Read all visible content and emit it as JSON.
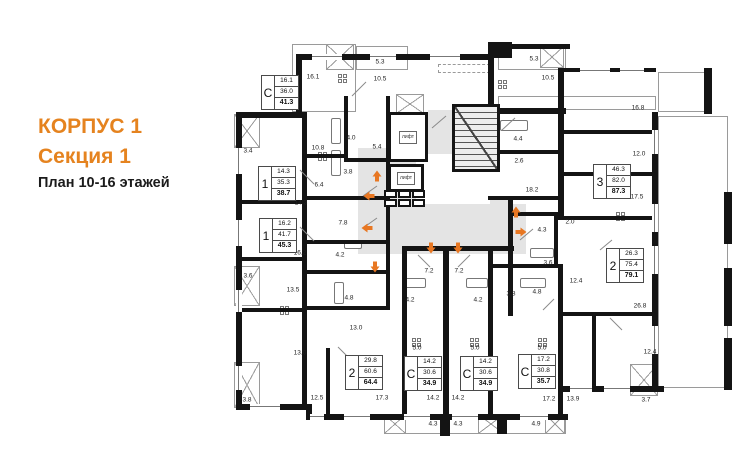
{
  "header": {
    "building": "КОРПУС 1",
    "section": "Секция 1",
    "plan": "План 10-16 этажей"
  },
  "colors": {
    "accent": "#E5831F",
    "arrow": "#E87722",
    "wall": "#141414",
    "corridor": "#E4E4E4"
  },
  "elevators": [
    {
      "label": "лифт",
      "x": 388,
      "y": 112,
      "w": 40,
      "h": 50
    },
    {
      "label": "лифт",
      "x": 388,
      "y": 164,
      "w": 36,
      "h": 28
    }
  ],
  "apartments": [
    {
      "type": "С",
      "room_area": "16.1",
      "living_area": "36.0",
      "total_area": "41.3",
      "x": 261,
      "y": 75
    },
    {
      "type": "1",
      "room_area": "14.3",
      "living_area": "35.3",
      "total_area": "38.7",
      "x": 258,
      "y": 166
    },
    {
      "type": "1",
      "room_area": "16.2",
      "living_area": "41.7",
      "total_area": "45.3",
      "x": 259,
      "y": 218
    },
    {
      "type": "3",
      "room_area": "46.3",
      "living_area": "82.0",
      "total_area": "87.3",
      "x": 593,
      "y": 164
    },
    {
      "type": "2",
      "room_area": "26.3",
      "living_area": "75.4",
      "total_area": "79.1",
      "x": 606,
      "y": 248
    },
    {
      "type": "2",
      "room_area": "29.8",
      "living_area": "60.6",
      "total_area": "64.4",
      "x": 345,
      "y": 355
    },
    {
      "type": "С",
      "room_area": "14.2",
      "living_area": "30.6",
      "total_area": "34.9",
      "x": 404,
      "y": 356
    },
    {
      "type": "С",
      "room_area": "14.2",
      "living_area": "30.6",
      "total_area": "34.9",
      "x": 460,
      "y": 356
    },
    {
      "type": "С",
      "room_area": "17.2",
      "living_area": "30.8",
      "total_area": "35.7",
      "x": 518,
      "y": 354
    }
  ],
  "room_labels": [
    {
      "t": "16.1",
      "x": 313,
      "y": 77
    },
    {
      "t": "5.3",
      "x": 380,
      "y": 62
    },
    {
      "t": "10.5",
      "x": 380,
      "y": 79
    },
    {
      "t": "5.3",
      "x": 534,
      "y": 59
    },
    {
      "t": "10.5",
      "x": 548,
      "y": 78
    },
    {
      "t": "3.4",
      "x": 248,
      "y": 151
    },
    {
      "t": "10.8",
      "x": 318,
      "y": 148
    },
    {
      "t": "4.0",
      "x": 351,
      "y": 138
    },
    {
      "t": "5.4",
      "x": 377,
      "y": 147
    },
    {
      "t": "3.8",
      "x": 348,
      "y": 172
    },
    {
      "t": "6.4",
      "x": 319,
      "y": 185
    },
    {
      "t": "14.3",
      "x": 301,
      "y": 203
    },
    {
      "t": "7.8",
      "x": 343,
      "y": 223
    },
    {
      "t": "16.2",
      "x": 300,
      "y": 253
    },
    {
      "t": "4.2",
      "x": 340,
      "y": 255
    },
    {
      "t": "3.6",
      "x": 248,
      "y": 276
    },
    {
      "t": "13.5",
      "x": 293,
      "y": 290
    },
    {
      "t": "4.8",
      "x": 349,
      "y": 298
    },
    {
      "t": "13.0",
      "x": 356,
      "y": 328
    },
    {
      "t": "13.0",
      "x": 300,
      "y": 353
    },
    {
      "t": "12.5",
      "x": 317,
      "y": 398
    },
    {
      "t": "17.3",
      "x": 382,
      "y": 398
    },
    {
      "t": "3.8",
      "x": 247,
      "y": 400
    },
    {
      "t": "7.2",
      "x": 429,
      "y": 271
    },
    {
      "t": "7.2",
      "x": 459,
      "y": 271
    },
    {
      "t": "4.2",
      "x": 410,
      "y": 300
    },
    {
      "t": "4.2",
      "x": 478,
      "y": 300
    },
    {
      "t": "5.0",
      "x": 417,
      "y": 348
    },
    {
      "t": "5.0",
      "x": 475,
      "y": 348
    },
    {
      "t": "14.2",
      "x": 433,
      "y": 398
    },
    {
      "t": "14.2",
      "x": 458,
      "y": 398
    },
    {
      "t": "4.3",
      "x": 433,
      "y": 424
    },
    {
      "t": "4.3",
      "x": 458,
      "y": 424
    },
    {
      "t": "4.9",
      "x": 536,
      "y": 424
    },
    {
      "t": "16.8",
      "x": 638,
      "y": 108
    },
    {
      "t": "12.0",
      "x": 639,
      "y": 154
    },
    {
      "t": "17.5",
      "x": 637,
      "y": 197
    },
    {
      "t": "2.0",
      "x": 570,
      "y": 222
    },
    {
      "t": "4.4",
      "x": 518,
      "y": 139
    },
    {
      "t": "2.6",
      "x": 519,
      "y": 161
    },
    {
      "t": "18.2",
      "x": 532,
      "y": 190
    },
    {
      "t": "4.3",
      "x": 542,
      "y": 230
    },
    {
      "t": "3.6",
      "x": 548,
      "y": 263
    },
    {
      "t": "12.4",
      "x": 576,
      "y": 281
    },
    {
      "t": "3.8",
      "x": 511,
      "y": 294
    },
    {
      "t": "4.8",
      "x": 537,
      "y": 292
    },
    {
      "t": "26.8",
      "x": 640,
      "y": 306
    },
    {
      "t": "5.0",
      "x": 542,
      "y": 348
    },
    {
      "t": "12.4",
      "x": 650,
      "y": 352
    },
    {
      "t": "17.2",
      "x": 549,
      "y": 399
    },
    {
      "t": "13.9",
      "x": 573,
      "y": 399
    },
    {
      "t": "3.7",
      "x": 646,
      "y": 400
    }
  ],
  "arrows": [
    {
      "dir": "up",
      "x": 377,
      "y": 175
    },
    {
      "dir": "left",
      "x": 369,
      "y": 195
    },
    {
      "dir": "left",
      "x": 367,
      "y": 227
    },
    {
      "dir": "down",
      "x": 375,
      "y": 266
    },
    {
      "dir": "down",
      "x": 431,
      "y": 247
    },
    {
      "dir": "down",
      "x": 458,
      "y": 247
    },
    {
      "dir": "up",
      "x": 516,
      "y": 211
    },
    {
      "dir": "right",
      "x": 521,
      "y": 231
    }
  ]
}
